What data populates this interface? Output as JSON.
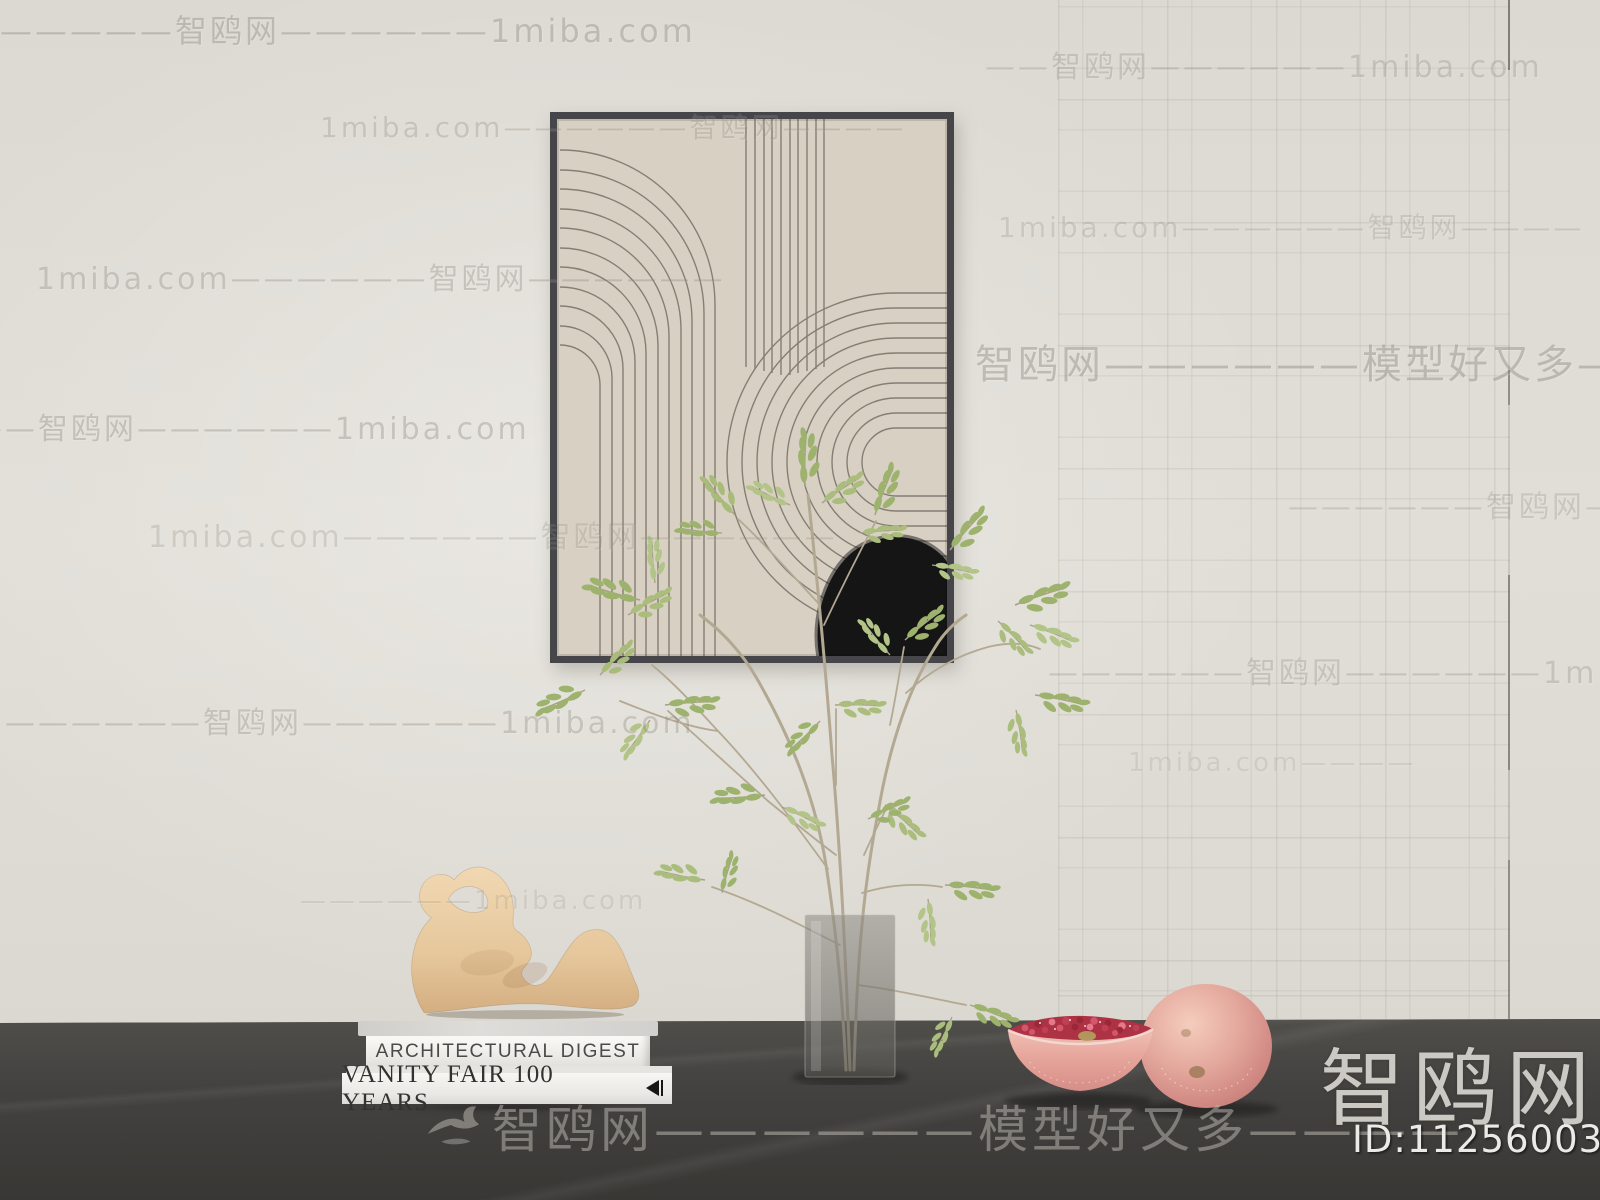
{
  "brand": {
    "site_name": "智鸥网",
    "model_id": "ID:112560039",
    "domain_name": "1miba.com",
    "slogan": "模型好又多"
  },
  "books": {
    "top_title": "ARCHITECTURAL DIGEST",
    "bottom_title": "VANITY FAIR 100 YEARS"
  },
  "watermarks": {
    "footer": {
      "text": "智鸥网——————模型好又多————"
    },
    "items": [
      {
        "text": "——————智鸥网——————1miba.com",
        "x": -35,
        "y": 6,
        "size": 32,
        "opacity": 0.4
      },
      {
        "text": "1miba.com——————智鸥网————",
        "x": 320,
        "y": 106,
        "size": 28,
        "opacity": 0.3
      },
      {
        "text": "——智鸥网——————1miba.com",
        "x": 985,
        "y": 42,
        "size": 30,
        "opacity": 0.3
      },
      {
        "text": "1miba.com——————智鸥网————",
        "x": 998,
        "y": 206,
        "size": 28,
        "opacity": 0.26
      },
      {
        "text": "1miba.com——————智鸥网——————",
        "x": 36,
        "y": 254,
        "size": 30,
        "opacity": 0.34
      },
      {
        "text": "智鸥网——————模型好又多——",
        "x": 975,
        "y": 332,
        "size": 40,
        "opacity": 0.42
      },
      {
        "text": "——智鸥网——————1miba.com",
        "x": -28,
        "y": 404,
        "size": 30,
        "opacity": 0.36
      },
      {
        "text": "1miba.com——————智鸥网——————",
        "x": 148,
        "y": 512,
        "size": 30,
        "opacity": 0.26
      },
      {
        "text": "——————智鸥网——",
        "x": 1288,
        "y": 482,
        "size": 30,
        "opacity": 0.28
      },
      {
        "text": "——————智鸥网——————1miba.com",
        "x": 5,
        "y": 698,
        "size": 30,
        "opacity": 0.34
      },
      {
        "text": "——————智鸥网——————1miba.com",
        "x": 1048,
        "y": 648,
        "size": 30,
        "opacity": 0.3
      },
      {
        "text": "1miba.com————",
        "x": 1128,
        "y": 748,
        "size": 26,
        "opacity": 0.18
      },
      {
        "text": "——————1miba.com",
        "x": 300,
        "y": 886,
        "size": 26,
        "opacity": 0.2
      }
    ]
  },
  "colors": {
    "wall": "#dfdcd5",
    "floor": "#454240",
    "art_canvas": "#d8d0c2",
    "art_frame": "#46464a",
    "art_line": "#7d766c",
    "leaf_green": "#9cb26d",
    "sculpture_tan": "#ecd0a6",
    "pomegranate_skin": "#e3a79c",
    "pomegranate_seeds": "#ad3244"
  }
}
